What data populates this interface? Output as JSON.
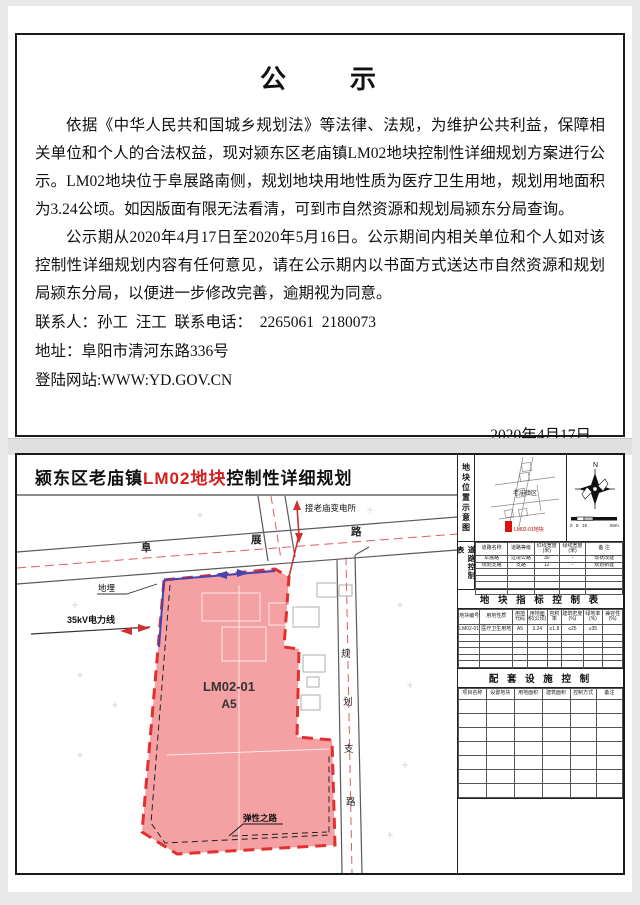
{
  "notice": {
    "title": "公　　示",
    "para1": "依据《中华人民共和国城乡规划法》等法律、法规，为维护公共利益，保障相关单位和个人的合法权益，现对颍东区老庙镇LM02地块控制性详细规划方案进行公示。LM02地块位于阜展路南侧，规划地块用地性质为医疗卫生用地，规划用地面积为3.24公顷。如因版面有限无法看清，可到市自然资源和规划局颍东分局查询。",
    "para2": "公示期从2020年4月17日至2020年5月16日。公示期间内相关单位和个人如对该控制性详细规划内容有任何意见，请在公示期内以书面方式送达市自然资源和规划局颍东分局，以便进一步修改完善，逾期视为同意。",
    "contact_line": "联系人：孙工  汪工  联系电话：  2265061  2180073",
    "address_line": "地址：阜阳市清河东路336号",
    "website_line": "登陆网站:WWW:YD.GOV.CN",
    "date": "2020年4月17日"
  },
  "map": {
    "title_prefix": "颍东区老庙镇",
    "title_highlight": "LM02地块",
    "title_suffix": "控制性详细规划",
    "labels": {
      "substation": "接老庙变电所",
      "road_fu": "阜",
      "road_zhan": "展",
      "road_lu": "路",
      "buried": "地埋",
      "power_line": "35kV电力线",
      "parcel_code": "LM02-01",
      "parcel_class": "A5",
      "elastic_road": "弹性之路",
      "branch_chars": [
        "规",
        "划",
        "支",
        "路"
      ]
    },
    "colors": {
      "parcel_fill": "#f4999b",
      "parcel_border": "#e03030",
      "road_line": "#5a5a5a",
      "centerline": "#d96060",
      "blue_line": "#4343b2",
      "power_red": "#cf3030"
    }
  },
  "sidebar": {
    "location_title": "地块位置示意图",
    "inset": {
      "town_label": "老庙镇区",
      "marker_label": "LM02-01地块"
    },
    "compass_n": "N",
    "scale_ticks": [
      "0",
      "5",
      "15",
      "50m"
    ],
    "road_table": {
      "title": "道路控制表",
      "headers": [
        "道路名称",
        "道路等级",
        "红线宽度(米)",
        "绿线宽度(米)",
        "备 注"
      ],
      "rows": [
        [
          "阜展路",
          "过境公路",
          "30",
          "-",
          "现状改建"
        ],
        [
          "规划支路",
          "支路",
          "12",
          "-",
          "规划新建"
        ]
      ],
      "empty_rows": 4
    },
    "index_table": {
      "title": "地 块 指 标 控 制 表",
      "headers": [
        "地块编号",
        "用地性质",
        "用地代码",
        "用地面积(公顷)",
        "容积率",
        "建筑密度(%)",
        "绿地率(%)",
        "兼容性(%)"
      ],
      "rows": [
        [
          "LM02-01",
          "医疗卫生用地",
          "A5",
          "3.24",
          "≤1.8",
          "≤25",
          "≥35",
          ""
        ]
      ],
      "empty_rows": 5
    },
    "facility_table": {
      "title": "配 套 设 施 控 制",
      "headers": [
        "项目名称",
        "设置地块",
        "用地面积",
        "建筑面积",
        "控制方式",
        "备注"
      ],
      "rows": [],
      "empty_rows": 7
    }
  }
}
